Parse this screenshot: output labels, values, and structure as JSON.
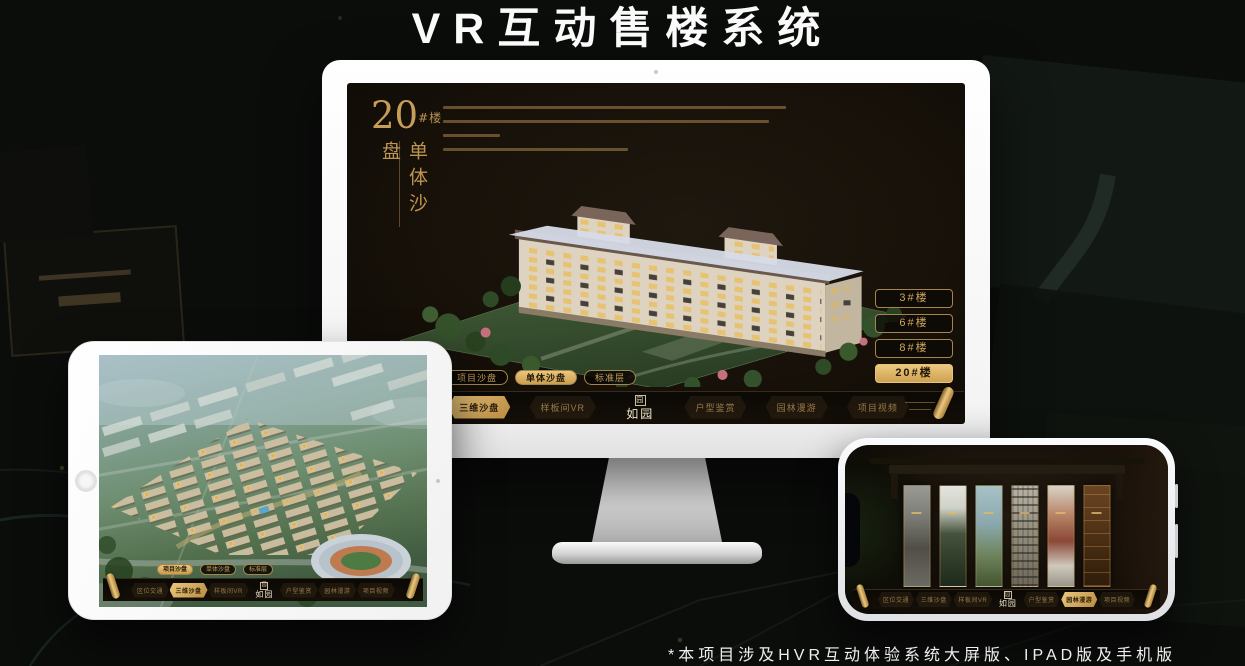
{
  "page": {
    "title": "VR互动售楼系统",
    "footnote": "*本项目涉及HVR互动体验系统大屏版、IPAD版及手机版"
  },
  "app_nav": {
    "logo": "如园",
    "logo_seal": "园",
    "left": [
      "区位交通",
      "三维沙盘",
      "样板间VR"
    ],
    "right": [
      "户型鉴赏",
      "园林漫游",
      "项目视频"
    ]
  },
  "subtabs": [
    "项目沙盘",
    "单体沙盘",
    "标准层"
  ],
  "desktop": {
    "panel": {
      "number": "20",
      "suffix": "#楼",
      "subtitle": "单体沙盘"
    },
    "building_buttons": [
      "3#楼",
      "6#楼",
      "8#楼",
      "20#楼"
    ],
    "active_building": "20#楼",
    "active_subtab": "单体沙盘",
    "active_nav": "三维沙盘"
  },
  "tablet": {
    "active_subtab": "项目沙盘",
    "active_nav": "三维沙盘"
  },
  "phone": {
    "active_nav": "园林漫游"
  },
  "colors": {
    "gold": "#c9a263",
    "gold_bright": "#e8c478",
    "screen_bg": "#17120c"
  }
}
